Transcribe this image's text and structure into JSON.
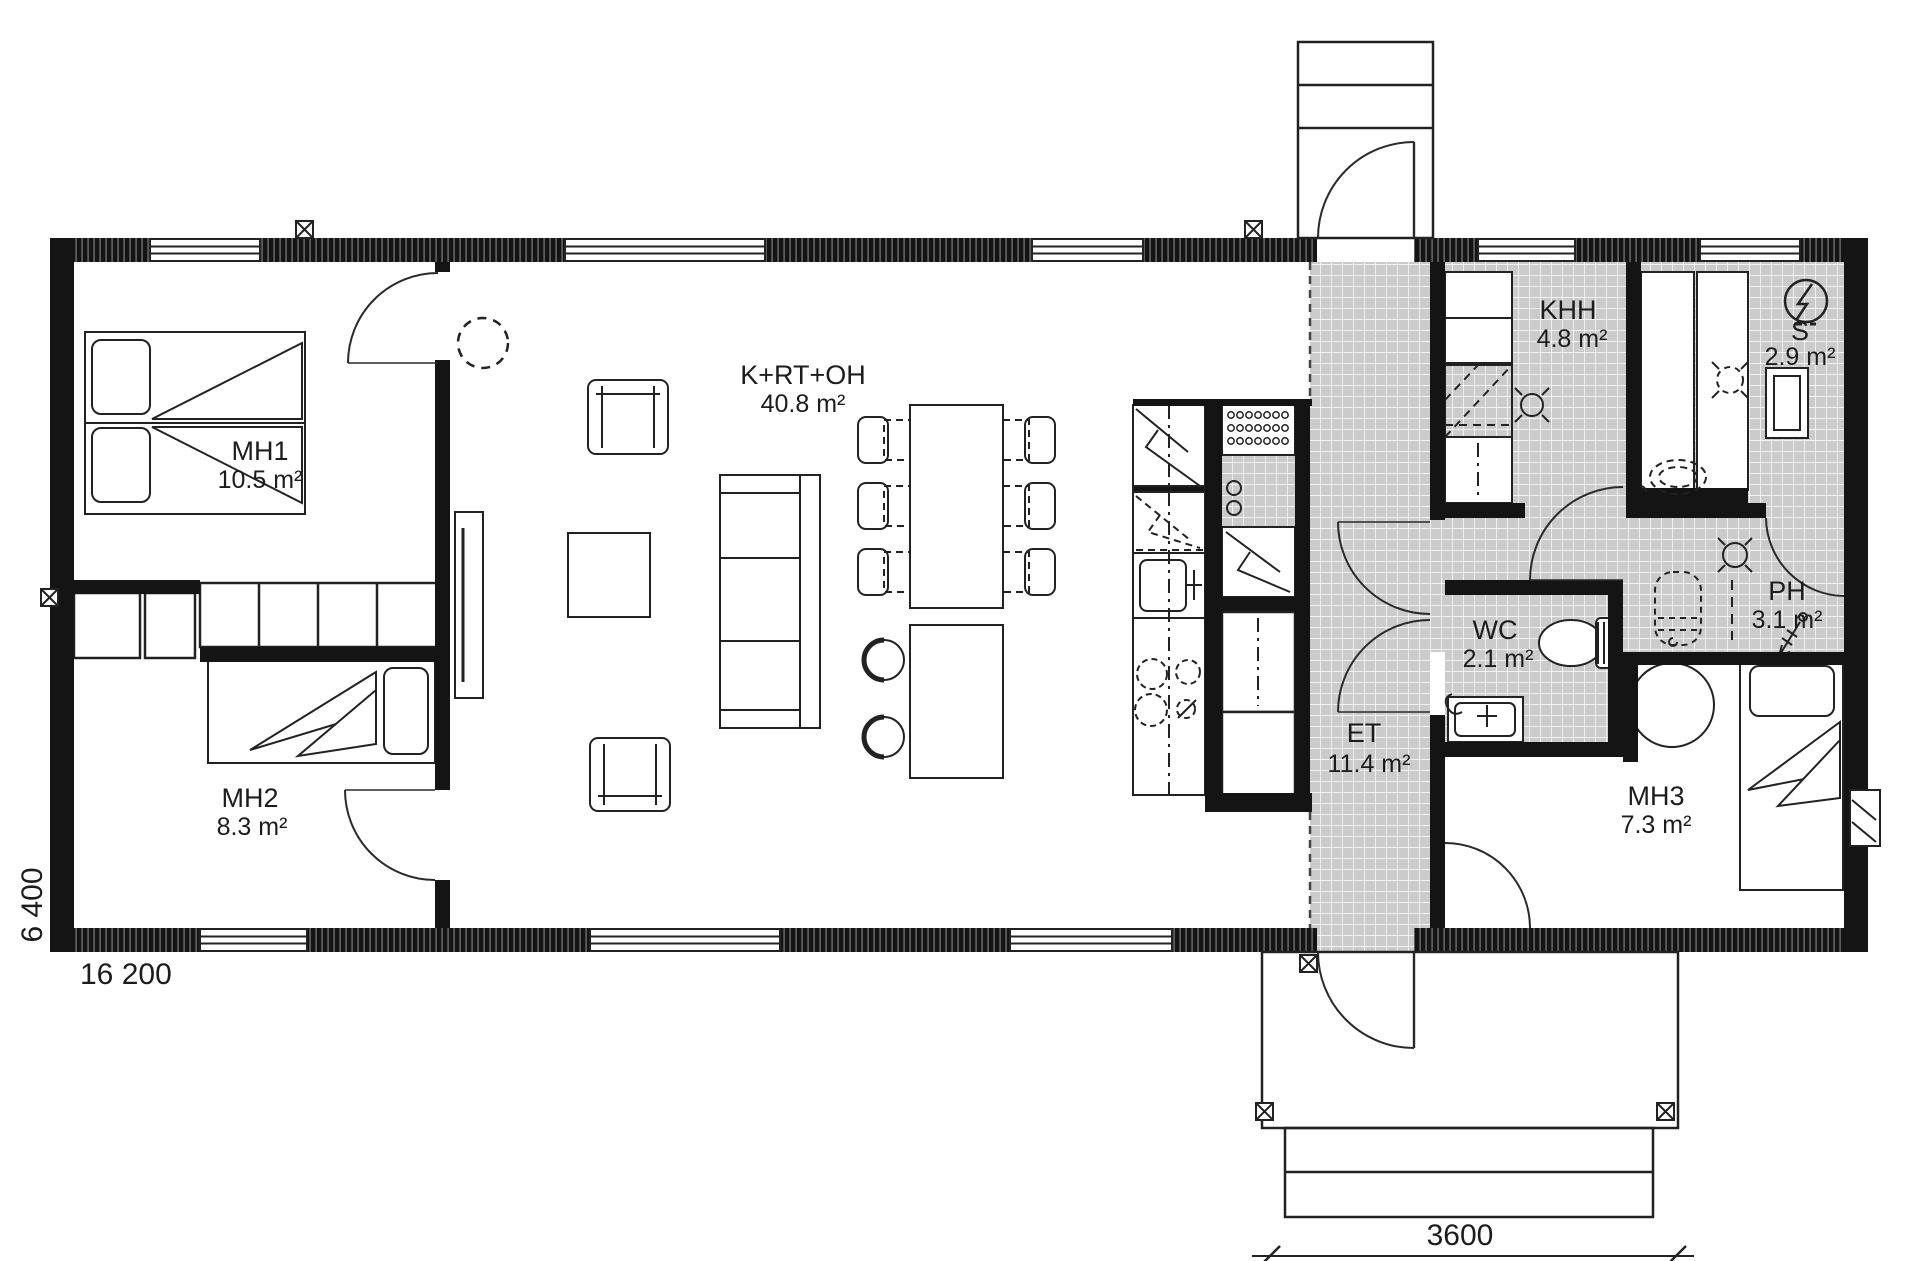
{
  "plan": {
    "type": "floor-plan",
    "rooms": [
      {
        "id": "mh1",
        "name": "MH1",
        "area": "10.5 m²"
      },
      {
        "id": "mh2",
        "name": "MH2",
        "area": "8.3 m²"
      },
      {
        "id": "living",
        "name": "K+RT+OH",
        "area": "40.8 m²"
      },
      {
        "id": "et",
        "name": "ET",
        "area": "11.4 m²"
      },
      {
        "id": "khh",
        "name": "KHH",
        "area": "4.8 m²"
      },
      {
        "id": "sauna",
        "name": "S",
        "area": "2.9 m²"
      },
      {
        "id": "wc",
        "name": "WC",
        "area": "2.1 m²"
      },
      {
        "id": "ph",
        "name": "PH",
        "area": "3.1 m²"
      },
      {
        "id": "mh3",
        "name": "MH3",
        "area": "7.3 m²"
      }
    ],
    "dimensions": {
      "overall_width_mm": "16 200",
      "overall_depth_mm": "6 400",
      "porch_width_mm": "3600"
    },
    "colors": {
      "wall": "#141414",
      "tile_floor": "#cbcbcb",
      "line": "#222222",
      "background": "#ffffff"
    },
    "icons": [
      "sauna-stove-icon",
      "floor-drain-icon",
      "ceiling-light-icon",
      "shower-icon",
      "post-marker-icon",
      "vent-marker-icon"
    ]
  }
}
